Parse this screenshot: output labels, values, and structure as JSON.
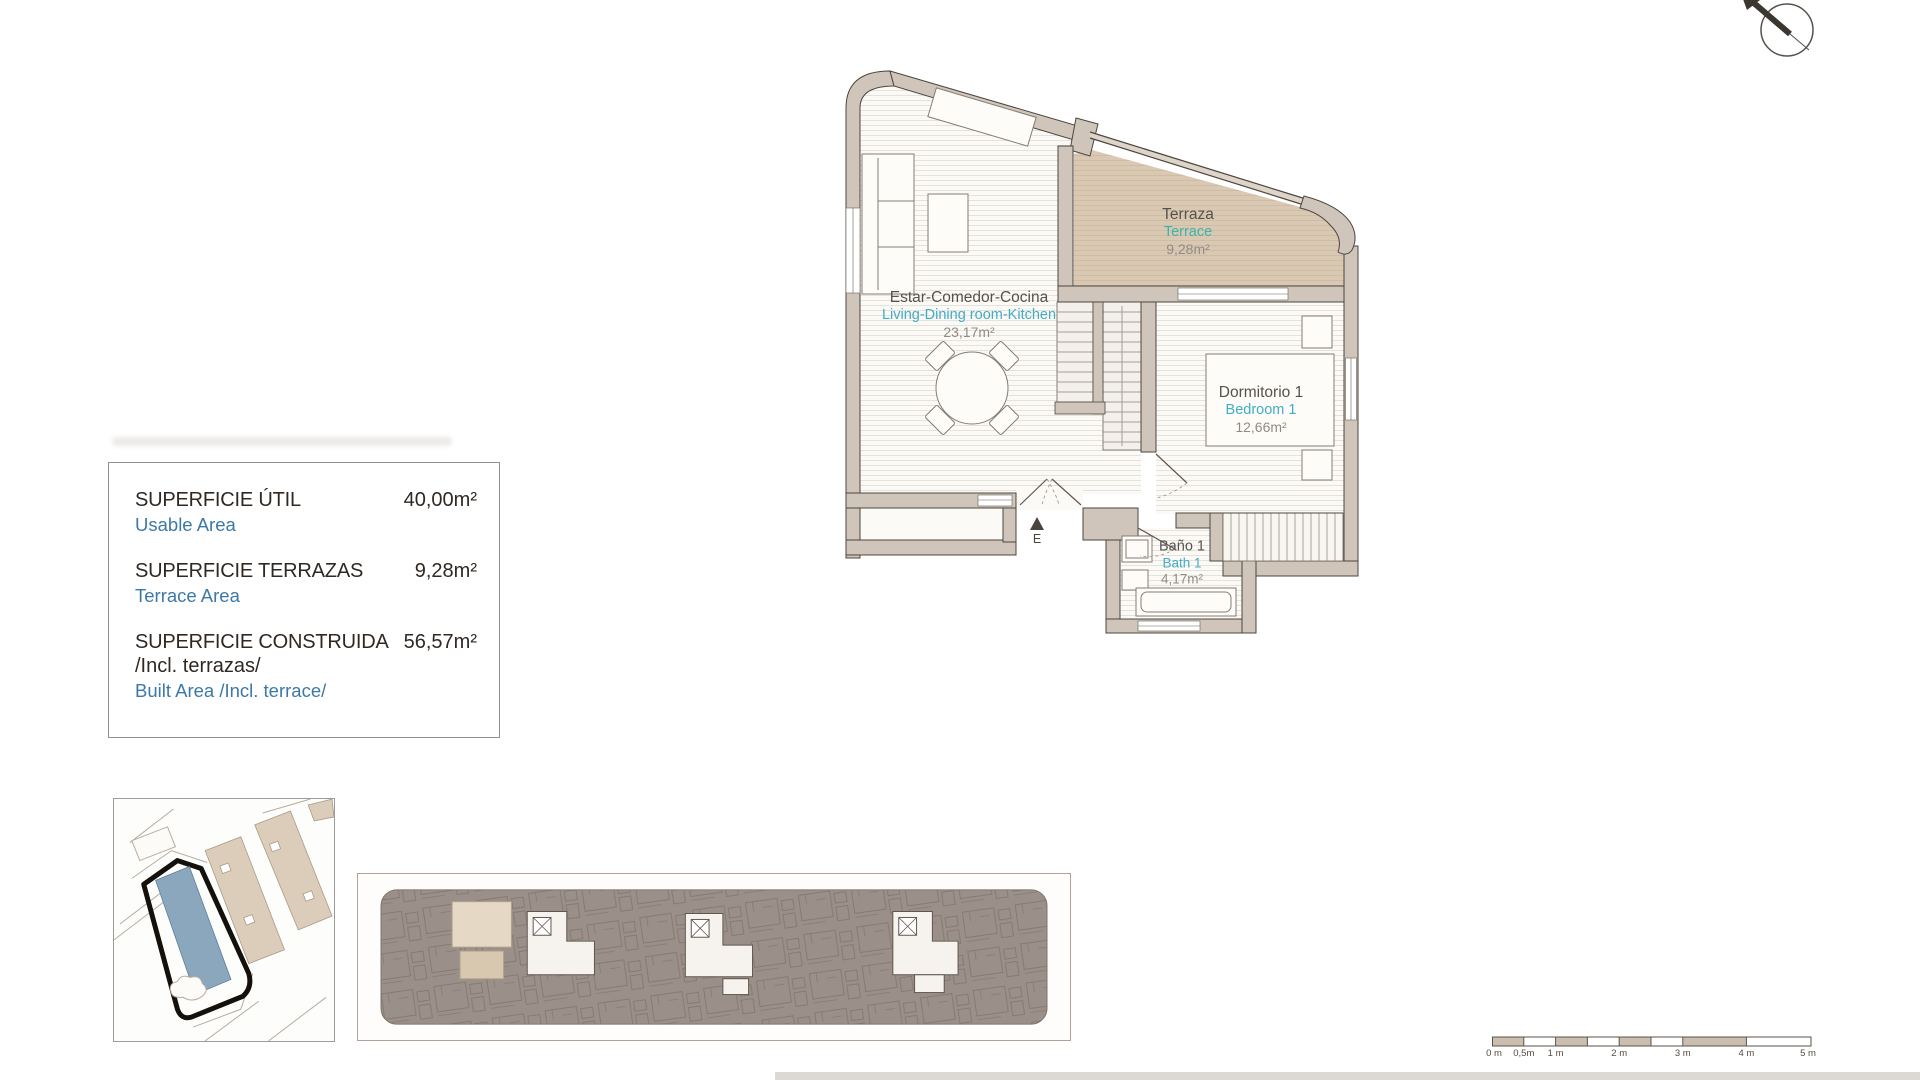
{
  "info_panel": {
    "rows": [
      {
        "label_es": "SUPERFICIE ÚTIL",
        "label_es_extra": "",
        "label_en": "Usable Area",
        "value": "40,00m²"
      },
      {
        "label_es": "SUPERFICIE TERRAZAS",
        "label_es_extra": "",
        "label_en": "Terrace Area",
        "value": "9,28m²"
      },
      {
        "label_es": "SUPERFICIE CONSTRUIDA",
        "label_es_extra": "/Incl. terrazas/",
        "label_en": "Built Area /Incl. terrace/",
        "value": "56,57m²"
      }
    ]
  },
  "floor_plan": {
    "rooms": [
      {
        "name_es": "Terraza",
        "name_en": "Terrace",
        "area": "9,28m²"
      },
      {
        "name_es": "Estar-Comedor-Cocina",
        "name_en": "Living-Dining room-Kitchen",
        "area": "23,17m²"
      },
      {
        "name_es": "Dormitorio 1",
        "name_en": "Bedroom 1",
        "area": "12,66m²"
      },
      {
        "name_es": "Baño 1",
        "name_en": "Bath 1",
        "area": "4,17m²"
      }
    ],
    "entry_label": "E"
  },
  "scale_bar": {
    "labels": [
      "0 m",
      "0,5m",
      "1 m",
      "2 m",
      "3 m",
      "4 m",
      "5 m"
    ]
  },
  "colors": {
    "wall": "#cfc5ba",
    "terrace_fill": "#d9c8b2",
    "teal_green": "#3eb3ab",
    "teal_cyan": "#41adc6",
    "info_blue": "#3c79a8",
    "dark_text": "#2f2823",
    "site_highlight": "#8aa7bd",
    "overview_gray": "#9b9089",
    "scale_tan": "#cbbeae"
  }
}
